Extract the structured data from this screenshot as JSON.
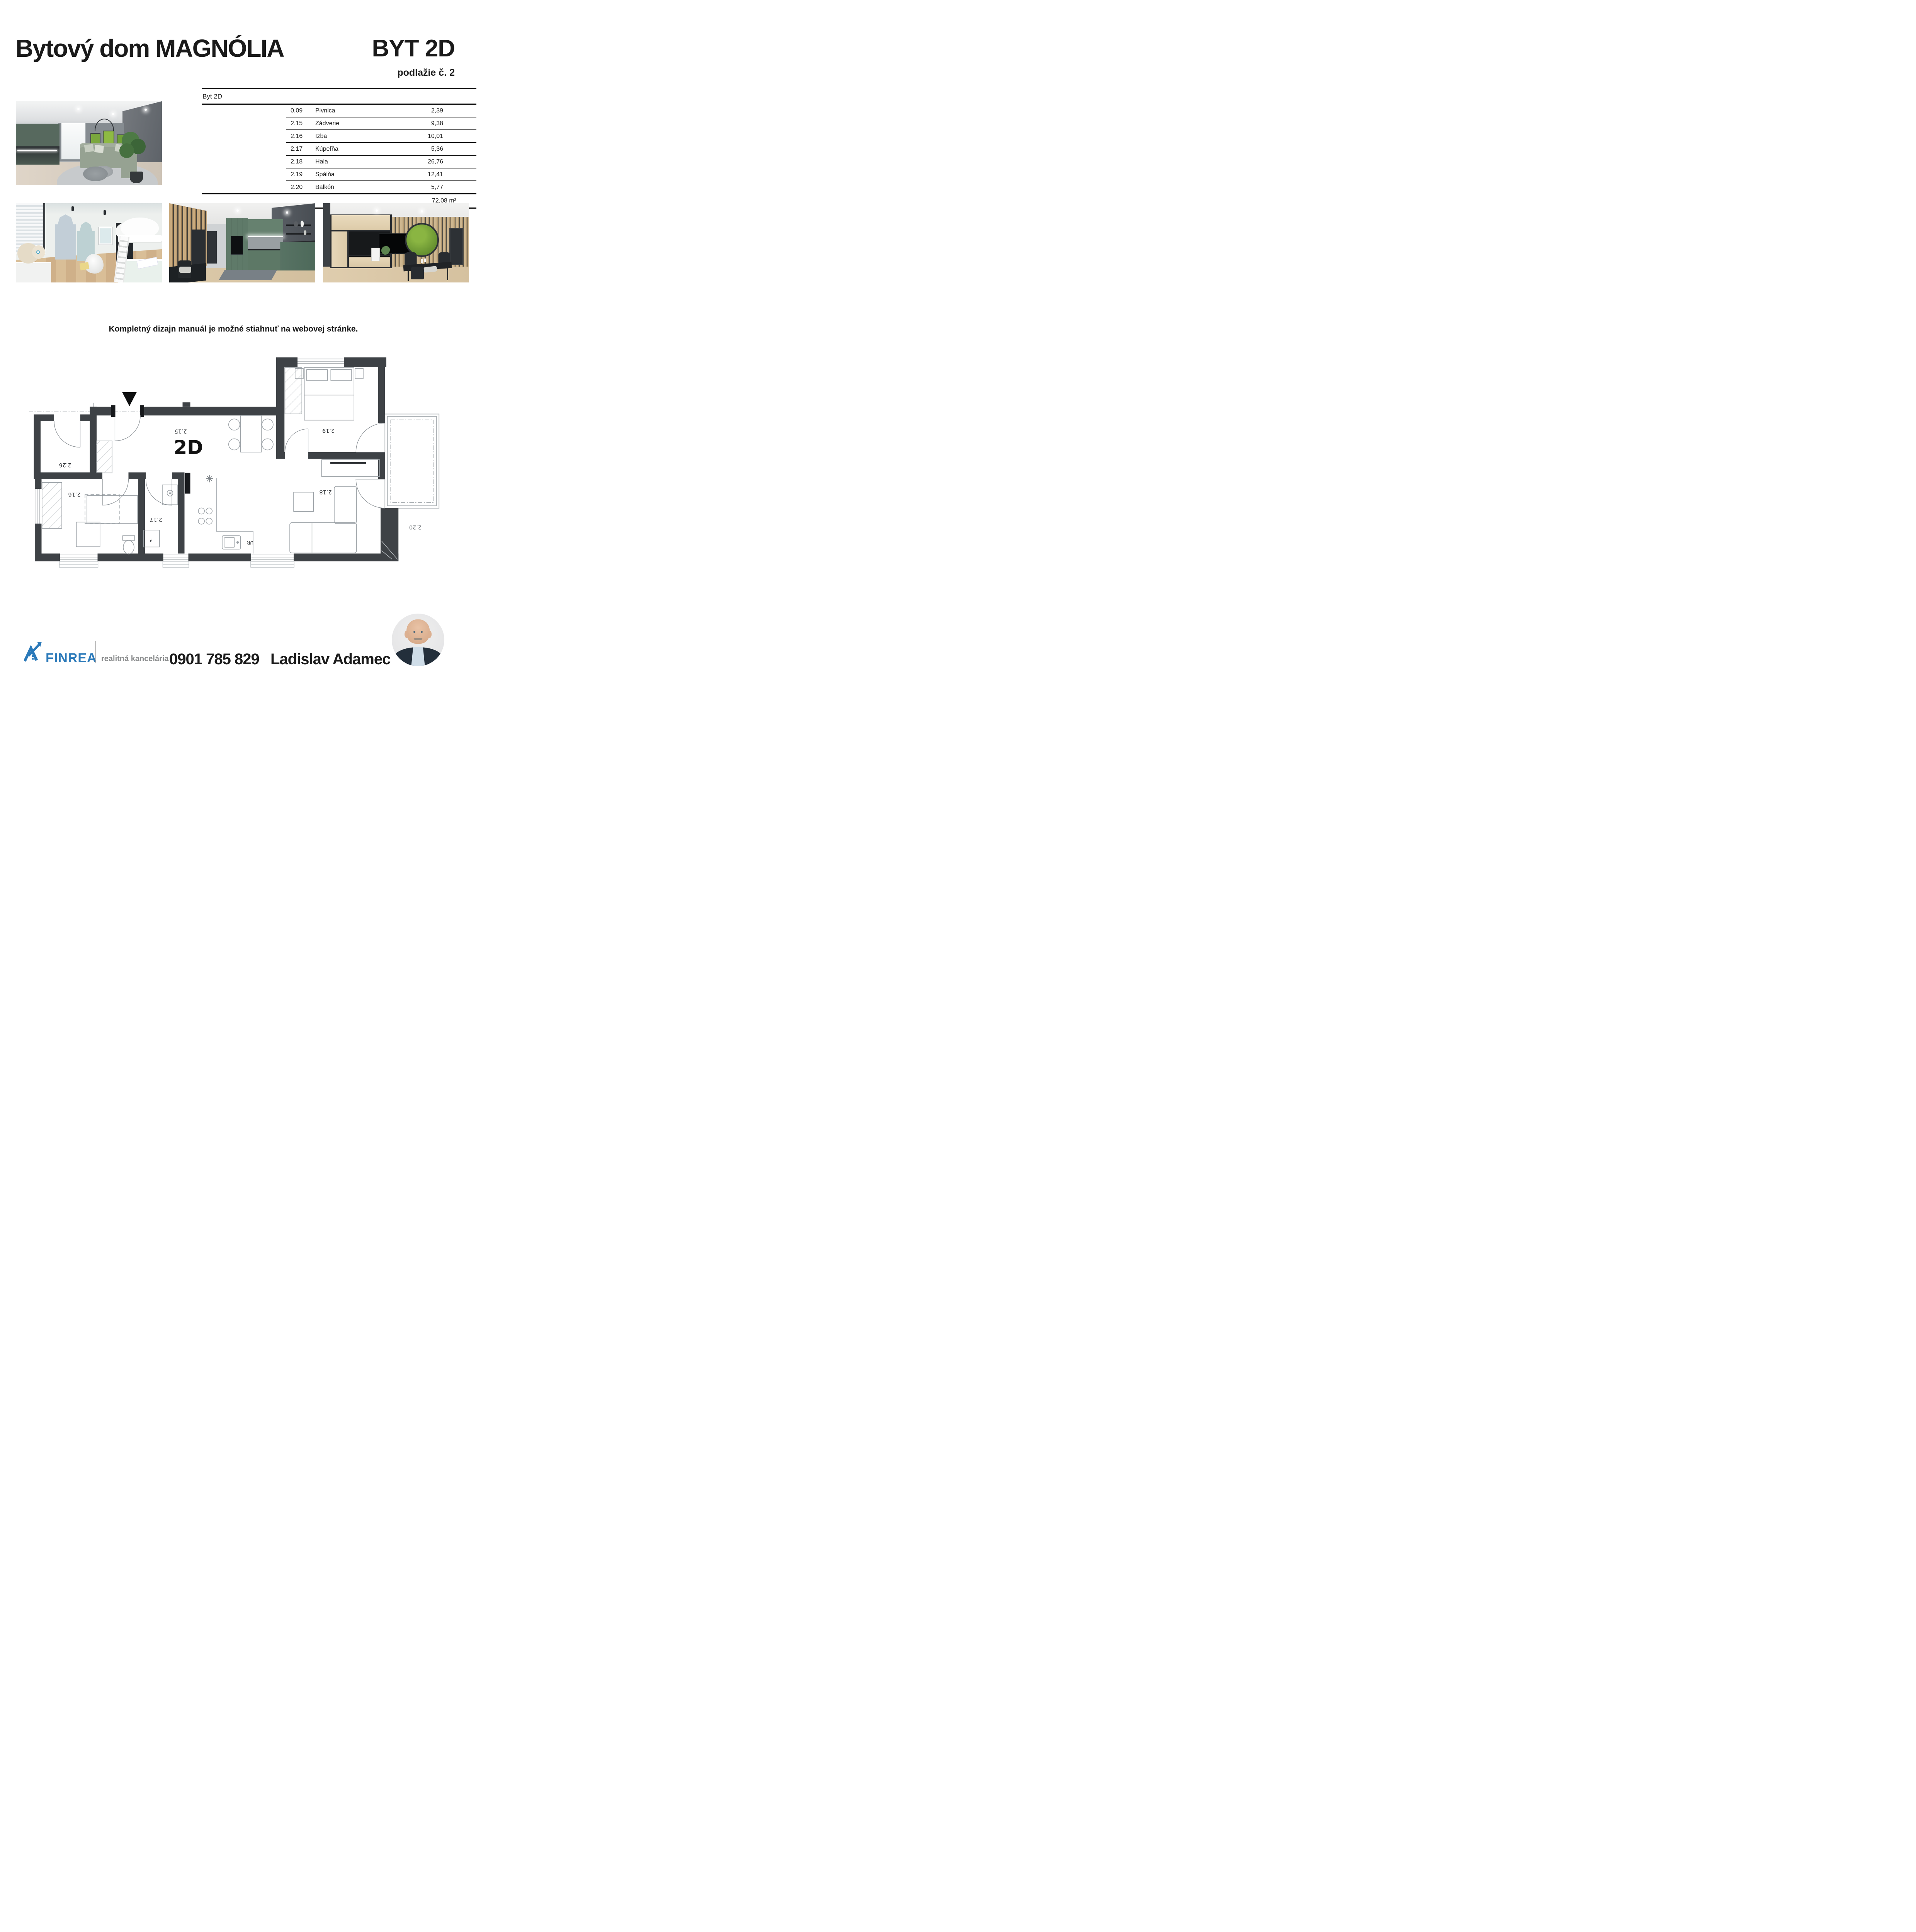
{
  "header": {
    "title": "Bytový dom MAGNÓLIA",
    "unit": "BYT 2D",
    "floor_label": "podlažie č. 2"
  },
  "area_table": {
    "header": "Byt 2D",
    "rows": [
      {
        "code": "0.09",
        "name": "Pivnica",
        "area": "2,39"
      },
      {
        "code": "2.15",
        "name": "Zádverie",
        "area": "9,38"
      },
      {
        "code": "2.16",
        "name": "Izba",
        "area": "10,01"
      },
      {
        "code": "2.17",
        "name": "Kúpeľňa",
        "area": "5,36"
      },
      {
        "code": "2.18",
        "name": "Hala",
        "area": "26,76"
      },
      {
        "code": "2.19",
        "name": "Spálňa",
        "area": "12,41"
      },
      {
        "code": "2.20",
        "name": "Balkón",
        "area": "5,77"
      }
    ],
    "total": "72,08 m²"
  },
  "note": "Kompletný dizajn manuál je možné stiahnuť na webovej stránke.",
  "floorplan": {
    "unit_label": "2D",
    "room_labels": {
      "r215": "2.15",
      "r216": "2.16",
      "r217": "2.17",
      "r218": "2.18",
      "r219": "2.19",
      "r220": "2.20",
      "r226": "2.26"
    },
    "fixture_labels": {
      "washer": "P",
      "sink": "UR"
    }
  },
  "footer": {
    "brand": "FINREA",
    "tagline": "realitná kancelária",
    "phone": "0901 785 829",
    "agent": "Ladislav Adamec",
    "brand_color": "#2a79b9"
  }
}
